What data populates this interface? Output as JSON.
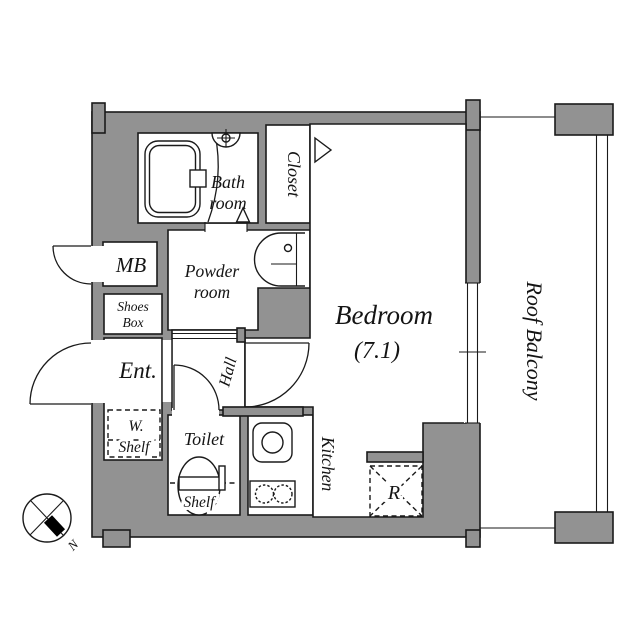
{
  "colors": {
    "wall": "#929292",
    "line": "#1a1a1a",
    "floor": "#ffffff"
  },
  "rooms": {
    "bathroom": {
      "line1": "Bath",
      "line2": "room"
    },
    "closet": {
      "label": "Closet"
    },
    "powder_room": {
      "line1": "Powder",
      "line2": "room"
    },
    "meter_box": {
      "label": "MB"
    },
    "shoes_box": {
      "line1": "Shoes",
      "line2": "Box"
    },
    "entrance": {
      "label": "Ent."
    },
    "w_shelf": {
      "line1": "W.",
      "line2": "Shelf"
    },
    "hall": {
      "label": "Hall"
    },
    "toilet": {
      "label": "Toilet",
      "shelf": "Shelf"
    },
    "kitchen": {
      "label": "Kitchen"
    },
    "bedroom": {
      "name": "Bedroom",
      "size": "(7.1)"
    },
    "refrigerator": {
      "label": "R"
    },
    "roof_balcony": {
      "label": "Roof Balcony"
    }
  },
  "compass": {
    "north": "N"
  },
  "icons": {
    "bathtub": "double-outline rounded rect",
    "wash_basin": "semicircle with faucet cross",
    "powder_sink": "round-front vanity with faucet dot",
    "toilet_bowl": "egg shape with seat band",
    "kitchen_sink": "rounded square with circle",
    "stove_burners": "two ticked circles",
    "window": "double parallel lines",
    "compass": "circle with cross and black needle"
  }
}
